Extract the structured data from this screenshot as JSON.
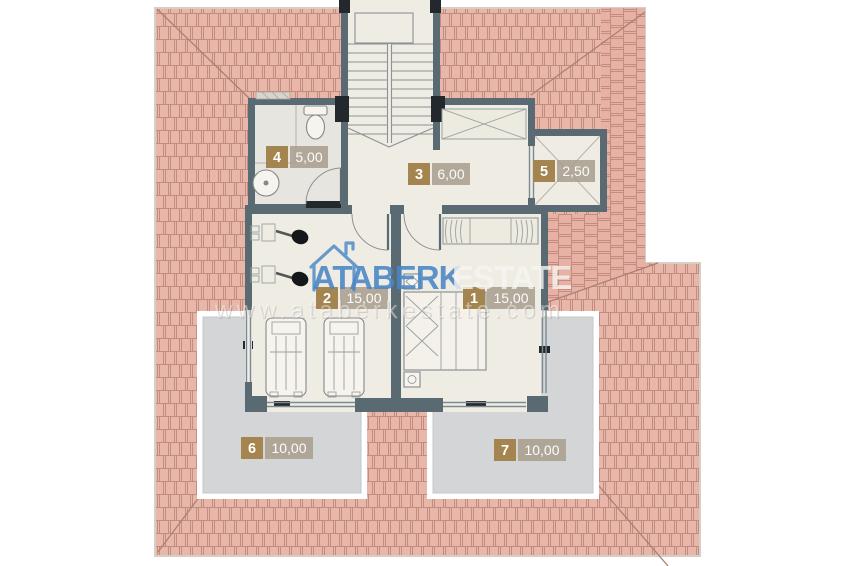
{
  "watermark": {
    "brand_primary": "ATABERK",
    "brand_secondary": "ESTATE",
    "website": "www.ataberkestate.com"
  },
  "rooms": [
    {
      "number": "4",
      "area": "5,00"
    },
    {
      "number": "3",
      "area": "6,00"
    },
    {
      "number": "5",
      "area": "2,50"
    },
    {
      "number": "2",
      "area": "15,00"
    },
    {
      "number": "1",
      "area": "15,00"
    },
    {
      "number": "6",
      "area": "10,00"
    },
    {
      "number": "7",
      "area": "10,00"
    }
  ],
  "colors": {
    "roof_tile": "#e9b6aa",
    "roof_line": "#c28c7e",
    "wall": "#5a6a72",
    "floor": "#efece4",
    "bath_floor": "#e7e5e0",
    "terrace": "#d3d5d6",
    "badge": "#a5854f",
    "area_label_bg": "#a89d8d",
    "brand_blue": "#4a86c6",
    "black_accent": "#23282c"
  }
}
